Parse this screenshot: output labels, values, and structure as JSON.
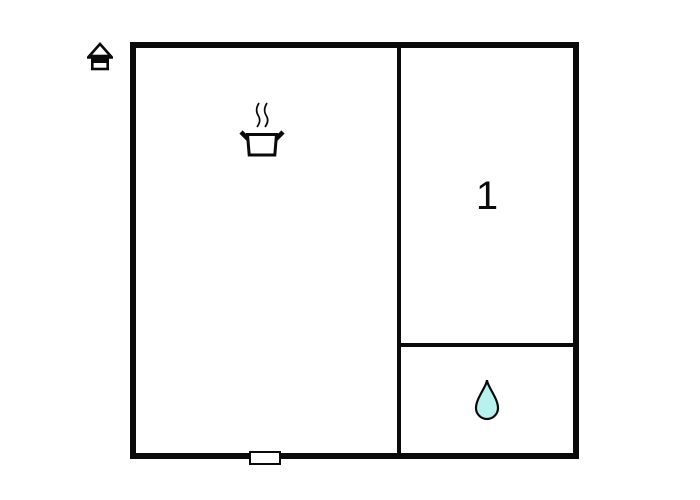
{
  "page": {
    "background": "#ffffff"
  },
  "floorplan": {
    "wall_color": "#0a0a0a",
    "icons": {
      "house": "house-icon",
      "cooking_pot": "cooking-pot-icon",
      "water_drop": "water-drop-icon"
    },
    "water_drop_fill": "#b8f2ee",
    "rooms": {
      "main": {
        "label": "",
        "icon": "cooking-pot-icon"
      },
      "room1": {
        "label": "1"
      },
      "bath": {
        "label": "",
        "icon": "water-drop-icon"
      }
    },
    "door_marker": "door-opening"
  }
}
